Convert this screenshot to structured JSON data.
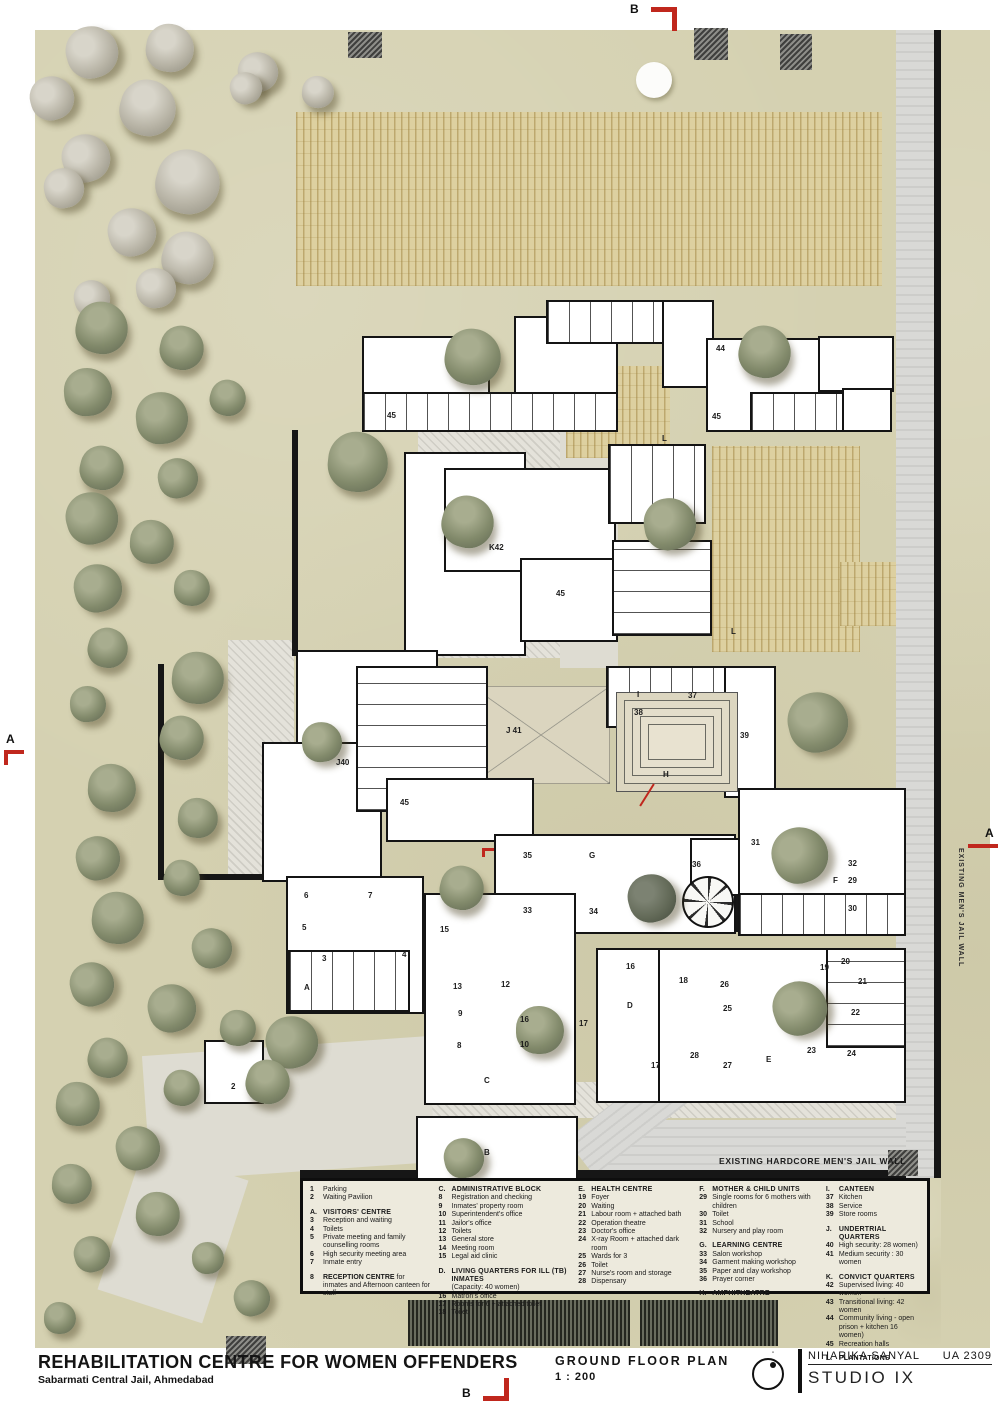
{
  "title_block": {
    "title": "REHABILITATION CENTRE FOR WOMEN OFFENDERS",
    "subtitle": "Sabarmati Central Jail, Ahmedabad",
    "drawing_name": "GROUND FLOOR PLAN",
    "scale": "1 : 200",
    "author": "NIHARIKA SANYAL",
    "code": "UA 2309",
    "studio": "STUDIO IX"
  },
  "section_markers": {
    "top": "B",
    "bottom": "B",
    "left": "A",
    "right": "A"
  },
  "wall_labels": {
    "right": "EXISTING MEN'S JAIL WALL",
    "bottom": "EXISTING HARDCORE MEN'S JAIL WALL"
  },
  "colors": {
    "ground": "#d5d1b1",
    "field": "#ddd0a0",
    "road": "#d9d9d6",
    "wall": "#161616",
    "red": "#c0271d",
    "tree_green": "#828a6b",
    "tree_pale": "#b8b4a6",
    "tree_dark": "#636a58"
  },
  "legend": {
    "widths": [
      128,
      140,
      120,
      126,
      100
    ],
    "columns": [
      [
        {
          "n": "1",
          "t": "Parking"
        },
        {
          "n": "2",
          "t": "Waiting Pavilion"
        },
        {
          "sp": true
        },
        {
          "h": true,
          "n": "A.",
          "t": "VISITORS'  CENTRE"
        },
        {
          "n": "3",
          "t": "Reception and waiting"
        },
        {
          "n": "4",
          "t": "Toilets"
        },
        {
          "n": "5",
          "t": "Private meeting and family counselling rooms"
        },
        {
          "n": "6",
          "t": "High security meeting area"
        },
        {
          "n": "7",
          "t": "Inmate entry"
        },
        {
          "sp": true
        },
        {
          "n": "8",
          "b": "RECEPTION CENTRE",
          "t": " for inmates and Afternoon canteen for staff"
        }
      ],
      [
        {
          "h": true,
          "n": "C.",
          "t": "ADMINISTRATIVE BLOCK"
        },
        {
          "n": "8",
          "t": "Registration and checking"
        },
        {
          "n": "9",
          "t": "Inmates' property room"
        },
        {
          "n": "10",
          "t": "Superintendent's office"
        },
        {
          "n": "11",
          "t": "Jailor's office"
        },
        {
          "n": "12",
          "t": "Toilets"
        },
        {
          "n": "13",
          "t": "General store"
        },
        {
          "n": "14",
          "t": "Meeting room"
        },
        {
          "n": "15",
          "t": "Legal aid clinic"
        },
        {
          "sp": true
        },
        {
          "h": true,
          "n": "D.",
          "t": "LIVING QUARTERS FOR ILL (TB) INMATES"
        },
        {
          "n": "",
          "t": "(Capacity: 40 women)"
        },
        {
          "n": "16",
          "t": "Matron's office"
        },
        {
          "n": "17",
          "t": "Rooms for 6 + attached toilet"
        },
        {
          "n": "18",
          "t": "Toilet"
        }
      ],
      [
        {
          "h": true,
          "n": "E.",
          "t": "HEALTH CENTRE"
        },
        {
          "n": "19",
          "t": "Foyer"
        },
        {
          "n": "20",
          "t": "Waiting"
        },
        {
          "n": "21",
          "t": "Labour room + attached bath"
        },
        {
          "n": "22",
          "t": "Operation theatre"
        },
        {
          "n": "23",
          "t": "Doctor's office"
        },
        {
          "n": "24",
          "t": "X-ray Room + attached dark room"
        },
        {
          "n": "25",
          "t": "Wards for 3"
        },
        {
          "n": "26",
          "t": "Toilet"
        },
        {
          "n": "27",
          "t": "Nurse's room and storage"
        },
        {
          "n": "28",
          "t": "Dispensary"
        }
      ],
      [
        {
          "h": true,
          "n": "F.",
          "t": "MOTHER & CHILD UNITS"
        },
        {
          "n": "29",
          "t": "Single rooms for 6 mothers with children"
        },
        {
          "n": "30",
          "t": "Toilet"
        },
        {
          "n": "31",
          "t": "School"
        },
        {
          "n": "32",
          "t": "Nursery and play room"
        },
        {
          "sp": true
        },
        {
          "h": true,
          "n": "G.",
          "t": "LEARNING CENTRE"
        },
        {
          "n": "33",
          "t": "Salon workshop"
        },
        {
          "n": "34",
          "t": "Garment making workshop"
        },
        {
          "n": "35",
          "t": "Paper and clay workshop"
        },
        {
          "n": "36",
          "t": "Prayer corner"
        },
        {
          "sp": true
        },
        {
          "h": true,
          "n": "H.",
          "t": "AMPHITHEATRE"
        }
      ],
      [
        {
          "h": true,
          "n": "I.",
          "t": "CANTEEN"
        },
        {
          "n": "37",
          "t": "Kitchen"
        },
        {
          "n": "38",
          "t": "Service"
        },
        {
          "n": "39",
          "t": "Store rooms"
        },
        {
          "sp": true
        },
        {
          "h": true,
          "n": "J.",
          "t": "UNDERTRIAL QUARTERS"
        },
        {
          "n": "40",
          "t": "High security: 28 women)"
        },
        {
          "n": "41",
          "t": "Medium security : 30 women"
        },
        {
          "sp": true
        },
        {
          "h": true,
          "n": "K.",
          "t": "CONVICT QUARTERS"
        },
        {
          "n": "42",
          "t": "Supervised living: 40 women"
        },
        {
          "n": "43",
          "t": "Transitional living: 42 women"
        },
        {
          "n": "44",
          "t": "Community living - open prison + kitchen 16 women)"
        },
        {
          "n": "45",
          "t": "Recreation halls"
        },
        {
          "sp": true
        },
        {
          "h": true,
          "n": "L.",
          "t": "PLANTATIONS"
        }
      ]
    ]
  },
  "site": {
    "grounds": [
      [
        35,
        30,
        863,
        1318
      ],
      [
        898,
        1176,
        43,
        172
      ],
      [
        941,
        30,
        49,
        1318
      ]
    ],
    "paths": [
      [
        418,
        428,
        196,
        230,
        0,
        "hatch"
      ],
      [
        228,
        640,
        66,
        236,
        0,
        "hatch"
      ],
      [
        424,
        1082,
        482,
        36,
        0,
        "hatch"
      ],
      [
        146,
        1046,
        286,
        126,
        -4,
        "plain"
      ],
      [
        118,
        1160,
        110,
        150,
        18,
        "plain"
      ],
      [
        560,
        430,
        58,
        238,
        0,
        "plain"
      ],
      [
        896,
        30,
        38,
        1148,
        0,
        "road"
      ],
      [
        600,
        1120,
        306,
        54,
        0,
        "road"
      ],
      [
        560,
        1076,
        190,
        46,
        -38,
        "road"
      ]
    ],
    "fields_crop": [
      [
        296,
        112,
        586,
        174
      ],
      [
        566,
        366,
        104,
        92
      ],
      [
        712,
        446,
        148,
        206
      ],
      [
        840,
        562,
        56,
        64
      ]
    ],
    "fields_dark": [
      [
        408,
        1300,
        222,
        46
      ],
      [
        640,
        1300,
        138,
        46
      ]
    ],
    "yards": [
      [
        472,
        686,
        138,
        98,
        "x"
      ],
      [
        758,
        806,
        100,
        100,
        ""
      ],
      [
        610,
        982,
        64,
        64,
        "x"
      ],
      [
        735,
        1028,
        90,
        72,
        ""
      ],
      [
        616,
        846,
        72,
        84,
        "green"
      ]
    ],
    "walls": [
      [
        292,
        430,
        6,
        226
      ],
      [
        158,
        664,
        6,
        216
      ],
      [
        158,
        874,
        140,
        6
      ],
      [
        300,
        1170,
        606,
        9
      ],
      [
        934,
        30,
        7,
        1148
      ],
      [
        678,
        872,
        60,
        60
      ]
    ],
    "buildings": [
      [
        362,
        336,
        128,
        94,
        ""
      ],
      [
        362,
        392,
        256,
        40,
        "v"
      ],
      [
        514,
        316,
        104,
        78,
        ""
      ],
      [
        546,
        300,
        168,
        44,
        "v"
      ],
      [
        662,
        300,
        52,
        88,
        ""
      ],
      [
        706,
        338,
        186,
        94,
        ""
      ],
      [
        750,
        392,
        142,
        40,
        "v"
      ],
      [
        818,
        336,
        76,
        56,
        ""
      ],
      [
        842,
        388,
        50,
        44,
        ""
      ],
      [
        404,
        452,
        122,
        204,
        ""
      ],
      [
        444,
        468,
        172,
        104,
        ""
      ],
      [
        520,
        558,
        98,
        84,
        ""
      ],
      [
        608,
        444,
        98,
        80,
        "v"
      ],
      [
        612,
        540,
        100,
        96,
        "h"
      ],
      [
        606,
        666,
        168,
        62,
        "v"
      ],
      [
        724,
        666,
        52,
        132,
        ""
      ],
      [
        296,
        650,
        142,
        118,
        ""
      ],
      [
        262,
        742,
        120,
        140,
        ""
      ],
      [
        356,
        666,
        132,
        146,
        "h"
      ],
      [
        386,
        778,
        148,
        64,
        ""
      ],
      [
        494,
        834,
        242,
        100,
        ""
      ],
      [
        690,
        838,
        58,
        58,
        ""
      ],
      [
        738,
        788,
        168,
        148,
        ""
      ],
      [
        738,
        893,
        168,
        43,
        "v"
      ],
      [
        286,
        876,
        138,
        138,
        ""
      ],
      [
        288,
        950,
        122,
        62,
        "v"
      ],
      [
        424,
        893,
        152,
        212,
        ""
      ],
      [
        596,
        948,
        180,
        155,
        ""
      ],
      [
        658,
        948,
        248,
        155,
        ""
      ],
      [
        826,
        948,
        80,
        100,
        "h"
      ],
      [
        416,
        1116,
        162,
        64,
        ""
      ],
      [
        204,
        1040,
        60,
        64,
        ""
      ]
    ],
    "amphi": [
      616,
      692,
      122,
      100
    ],
    "spiral": [
      682,
      876,
      52,
      52
    ],
    "water_circle": [
      636,
      62,
      36
    ],
    "patches": [
      [
        348,
        32,
        34,
        26
      ],
      [
        694,
        28,
        34,
        32
      ],
      [
        780,
        34,
        32,
        36
      ],
      [
        888,
        1150,
        30,
        26
      ],
      [
        226,
        1336,
        40,
        28
      ]
    ],
    "trees_pale": [
      [
        92,
        52,
        26
      ],
      [
        170,
        48,
        24
      ],
      [
        258,
        72,
        20
      ],
      [
        52,
        98,
        22
      ],
      [
        148,
        108,
        28
      ],
      [
        86,
        158,
        24
      ],
      [
        188,
        182,
        32
      ],
      [
        64,
        188,
        20
      ],
      [
        132,
        232,
        24
      ],
      [
        188,
        258,
        26
      ],
      [
        92,
        298,
        18
      ],
      [
        156,
        288,
        20
      ],
      [
        246,
        88,
        16
      ],
      [
        318,
        92,
        16
      ]
    ],
    "trees_green": [
      [
        102,
        328,
        26
      ],
      [
        182,
        348,
        22
      ],
      [
        88,
        392,
        24
      ],
      [
        162,
        418,
        26
      ],
      [
        228,
        398,
        18
      ],
      [
        102,
        468,
        22
      ],
      [
        92,
        518,
        26
      ],
      [
        178,
        478,
        20
      ],
      [
        152,
        542,
        22
      ],
      [
        98,
        588,
        24
      ],
      [
        192,
        588,
        18
      ],
      [
        108,
        648,
        20
      ],
      [
        198,
        678,
        26
      ],
      [
        88,
        704,
        18
      ],
      [
        182,
        738,
        22
      ],
      [
        112,
        788,
        24
      ],
      [
        198,
        818,
        20
      ],
      [
        98,
        858,
        22
      ],
      [
        182,
        878,
        18
      ],
      [
        118,
        918,
        26
      ],
      [
        212,
        948,
        20
      ],
      [
        92,
        984,
        22
      ],
      [
        172,
        1008,
        24
      ],
      [
        108,
        1058,
        20
      ],
      [
        78,
        1104,
        22
      ],
      [
        182,
        1088,
        18
      ],
      [
        138,
        1148,
        22
      ],
      [
        72,
        1184,
        20
      ],
      [
        158,
        1214,
        22
      ],
      [
        92,
        1254,
        18
      ],
      [
        208,
        1258,
        16
      ],
      [
        252,
        1298,
        18
      ],
      [
        60,
        1318,
        16
      ],
      [
        358,
        462,
        30
      ],
      [
        473,
        357,
        28
      ],
      [
        765,
        352,
        26
      ],
      [
        468,
        522,
        26
      ],
      [
        670,
        524,
        26
      ],
      [
        818,
        722,
        30
      ],
      [
        800,
        855,
        28
      ],
      [
        462,
        888,
        22
      ],
      [
        322,
        742,
        20
      ],
      [
        540,
        1030,
        24
      ],
      [
        292,
        1042,
        26
      ],
      [
        268,
        1082,
        22
      ],
      [
        464,
        1158,
        20
      ],
      [
        238,
        1028,
        18
      ],
      [
        800,
        1008,
        27
      ]
    ],
    "trees_dark": [
      [
        652,
        898,
        24
      ]
    ],
    "labels": [
      [
        "44",
        716,
        344
      ],
      [
        "45",
        387,
        411
      ],
      [
        "45",
        712,
        412
      ],
      [
        "L",
        662,
        434
      ],
      [
        "L",
        731,
        627
      ],
      [
        "K42",
        489,
        543
      ],
      [
        "45",
        556,
        589
      ],
      [
        "I",
        637,
        690
      ],
      [
        "37",
        688,
        691
      ],
      [
        "38",
        634,
        708
      ],
      [
        "39",
        740,
        731
      ],
      [
        "H",
        663,
        770
      ],
      [
        "J 41",
        506,
        726
      ],
      [
        "J40",
        336,
        758
      ],
      [
        "45",
        400,
        798
      ],
      [
        "31",
        751,
        838
      ],
      [
        "35",
        523,
        851
      ],
      [
        "G",
        589,
        851
      ],
      [
        "36",
        692,
        860
      ],
      [
        "32",
        848,
        859
      ],
      [
        "F",
        833,
        876
      ],
      [
        "29",
        848,
        876
      ],
      [
        "30",
        848,
        904
      ],
      [
        "33",
        523,
        906
      ],
      [
        "34",
        589,
        907
      ],
      [
        "6",
        304,
        891
      ],
      [
        "7",
        368,
        891
      ],
      [
        "5",
        302,
        923
      ],
      [
        "3",
        322,
        954
      ],
      [
        "4",
        402,
        950
      ],
      [
        "A",
        304,
        983
      ],
      [
        "15",
        440,
        925
      ],
      [
        "13",
        453,
        982
      ],
      [
        "12",
        501,
        980
      ],
      [
        "16",
        626,
        962
      ],
      [
        "18",
        679,
        976
      ],
      [
        "26",
        720,
        980
      ],
      [
        "19",
        820,
        963
      ],
      [
        "20",
        841,
        957
      ],
      [
        "21",
        858,
        977
      ],
      [
        "D",
        627,
        1001
      ],
      [
        "25",
        723,
        1004
      ],
      [
        "22",
        851,
        1008
      ],
      [
        "9",
        458,
        1009
      ],
      [
        "16",
        520,
        1015
      ],
      [
        "17",
        579,
        1019
      ],
      [
        "8",
        457,
        1041
      ],
      [
        "10",
        520,
        1040
      ],
      [
        "23",
        807,
        1046
      ],
      [
        "24",
        847,
        1049
      ],
      [
        "28",
        690,
        1051
      ],
      [
        "27",
        723,
        1061
      ],
      [
        "17",
        651,
        1061
      ],
      [
        "E",
        766,
        1055
      ],
      [
        "C",
        484,
        1076
      ],
      [
        "2",
        231,
        1082
      ],
      [
        "B",
        484,
        1148
      ]
    ],
    "reds": [
      [
        646,
        782,
        2,
        26,
        32
      ],
      [
        482,
        848,
        12,
        3,
        0
      ],
      [
        482,
        848,
        3,
        9,
        0
      ]
    ]
  }
}
